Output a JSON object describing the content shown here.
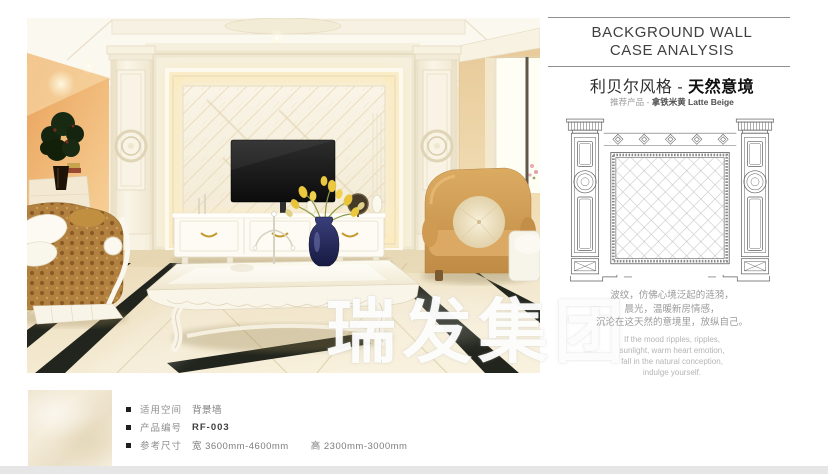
{
  "page": {
    "watermark": "瑞发集团"
  },
  "header": {
    "title_line1": "BACKGROUND WALL",
    "title_line2": "CASE ANALYSIS",
    "style_title": "利贝尔风格 - ",
    "style_title_bold": "天然意境",
    "subtitle_prefix": "推荐产品 - ",
    "subtitle_product": "拿铁米黄 Latte Beige"
  },
  "description": {
    "cn_lines": [
      "波纹，仿佛心境泛起的涟漪，",
      "晨光，温暖新房情感，",
      "沉沦在这天然的意境里，放纵自己。"
    ],
    "en_lines": [
      "If the mood ripples, ripples,",
      "sunlight, warm heart emotion,",
      "fall in the natural conception,",
      "indulge yourself."
    ]
  },
  "product_info": {
    "rows": [
      {
        "label": "适用空间",
        "value": "背景墙"
      },
      {
        "label": "产品编号",
        "value": "RF-003"
      },
      {
        "label": "参考尺寸",
        "value": "宽 3600mm-4600mm",
        "value2": "高 2300mm-3000mm"
      }
    ]
  },
  "colors": {
    "accent_wall_orange": "#eda95e",
    "marble_beige": "#f3ecd9",
    "armchair_tan": "#cf9a52",
    "sofa_gold": "#b2813f",
    "floor_inlay_black": "#22251d",
    "watermark_white": "#ffffff",
    "bottom_bar_gray": "#e6e6e6"
  }
}
